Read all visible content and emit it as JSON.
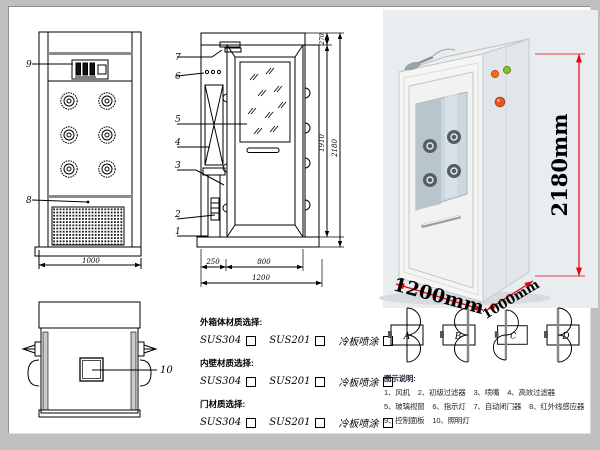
{
  "front_view": {
    "callout_panel": "9",
    "callout_grille": "8",
    "dim_width": "1000"
  },
  "section_view": {
    "callouts": [
      "7",
      "6",
      "5",
      "4",
      "3",
      "2",
      "1"
    ],
    "dims": {
      "top": "270",
      "door_height": "1910",
      "total_height": "2180",
      "left": "250",
      "door_width": "800",
      "total_width": "1200"
    }
  },
  "top_view": {
    "callout_lamp": "10"
  },
  "photo": {
    "height_label": "2180mm",
    "width_label": "1200mm",
    "depth_label": "1000mm",
    "dim_color": "#e30613",
    "indicator_colors": [
      "#e8701e",
      "#8db832",
      "#e2581e"
    ]
  },
  "materials": {
    "groups": [
      {
        "title": "外箱体材质选择:",
        "options": [
          "SUS304",
          "SUS201",
          "冷板喷涂"
        ]
      },
      {
        "title": "内壁材质选择:",
        "options": [
          "SUS304",
          "SUS201",
          "冷板喷涂"
        ]
      },
      {
        "title": "门材质选择:",
        "options": [
          "SUS304",
          "SUS201",
          "冷板喷涂"
        ]
      }
    ]
  },
  "doors": {
    "labels": [
      "A",
      "B",
      "C",
      "D"
    ]
  },
  "legend": {
    "title": "图示说明:",
    "items": [
      "1、风机",
      "2、初级过滤器",
      "3、喷嘴",
      "4、高效过滤器",
      "5、玻璃视窗",
      "6、指示灯",
      "7、自动闭门器",
      "8、红外线感应器",
      "9、控制面板",
      "10、照明灯"
    ]
  }
}
